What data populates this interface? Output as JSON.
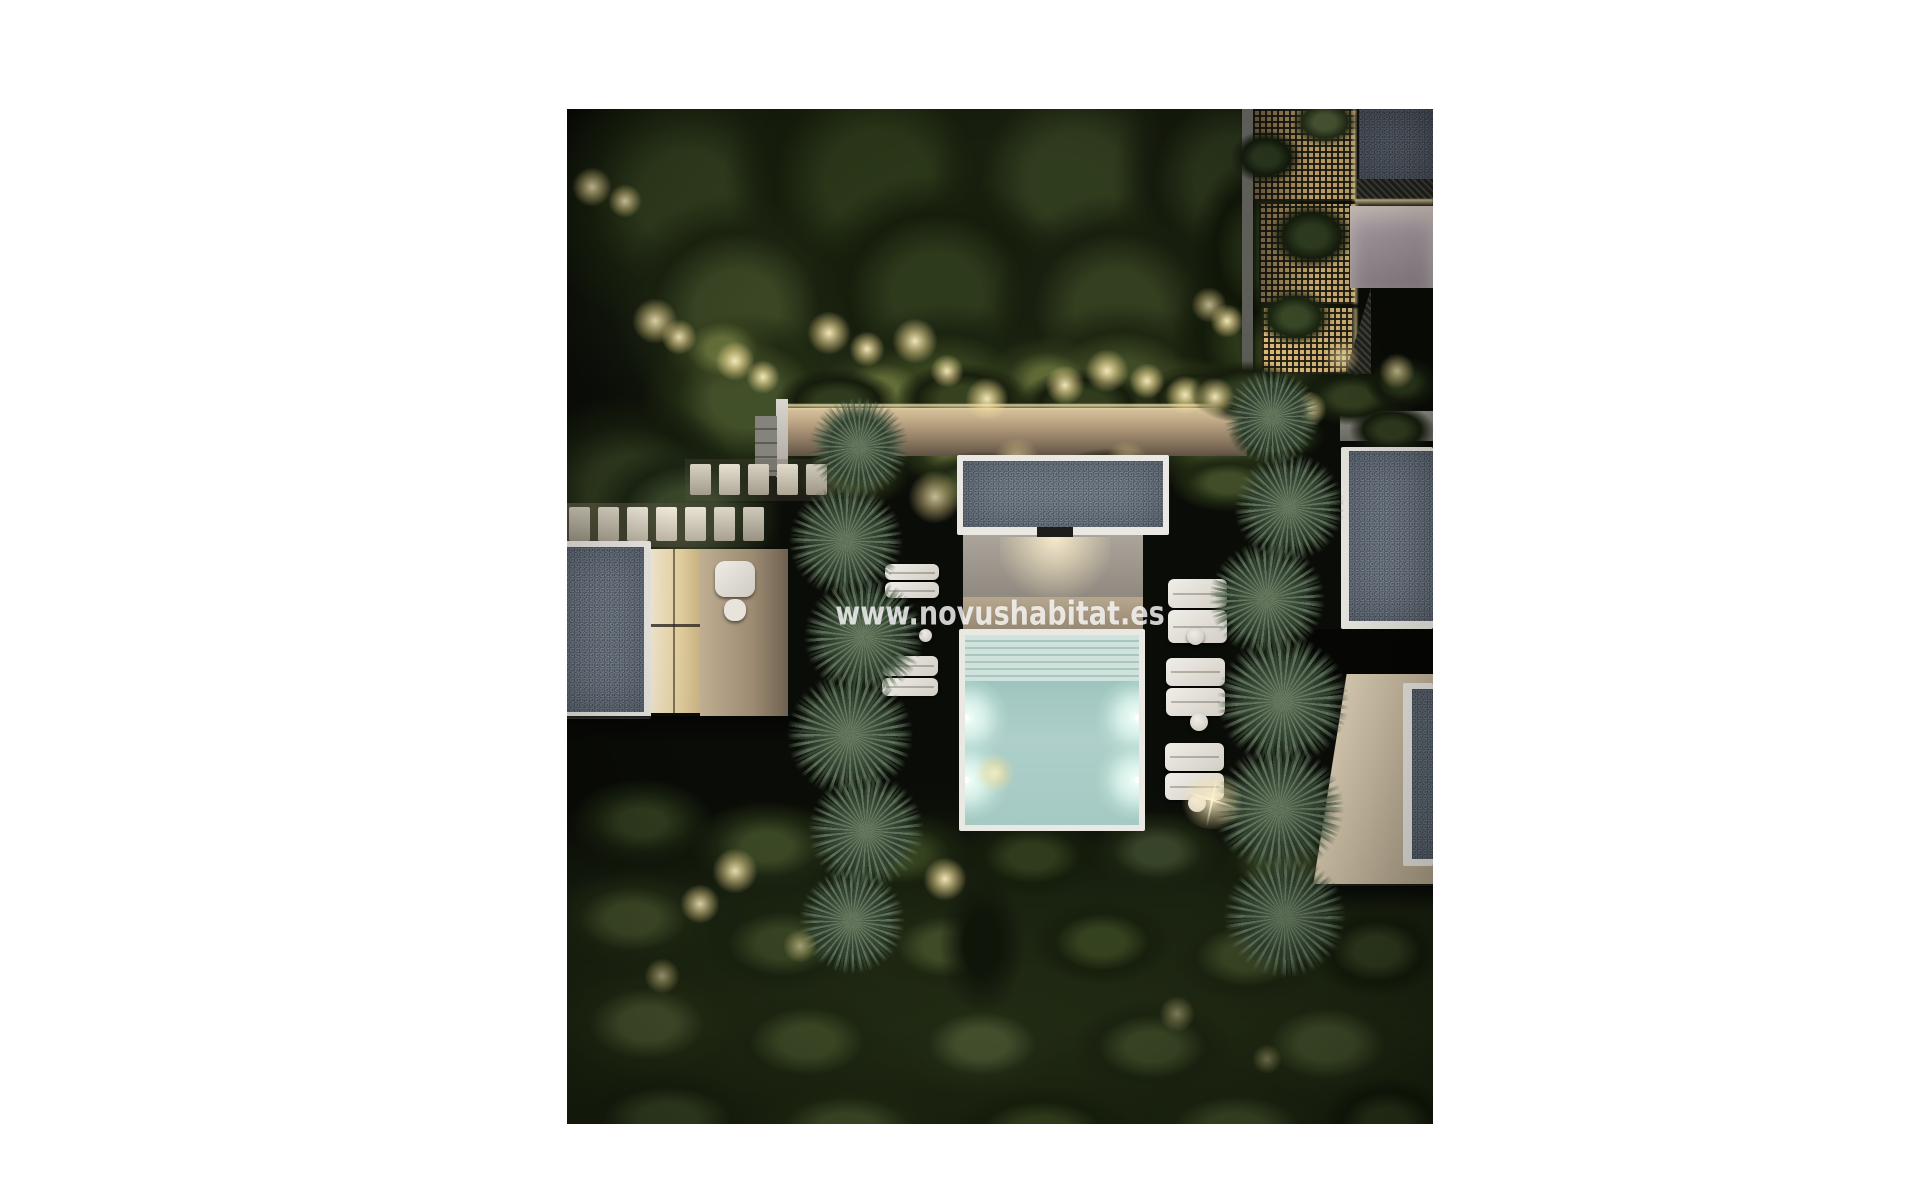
{
  "photo": {
    "kind": "night aerial 3D architectural render",
    "description": "Top-down night view of a modern villa garden: illuminated plunge pool with four underwater lights, white sun loungers with round side tables, two rows of palm trees, flat gravel roofs, warm garden up-lights in dense tree canopy, lit privacy walls, backlit lattice screens and shrubs",
    "watermark": "www.novushabitat.es"
  },
  "palette": {
    "page_bg": "#ffffff",
    "night_ground": "#0a0c07",
    "foliage_dark": "#243018",
    "foliage_light": "#4c5a33",
    "palm_green": "#465848",
    "roof_gray": "#727d89",
    "coping_white": "#eae8e2",
    "terrace_beige": "#b5a48c",
    "pool_water": "#a9cbc6",
    "pool_light": "#effaf4",
    "warm_light": "#f2dfa8",
    "lavender_wall": "#b6abb3",
    "cream_wall": "#d8cab2",
    "watermark_white": "rgba(255,255,255,0.8)"
  }
}
